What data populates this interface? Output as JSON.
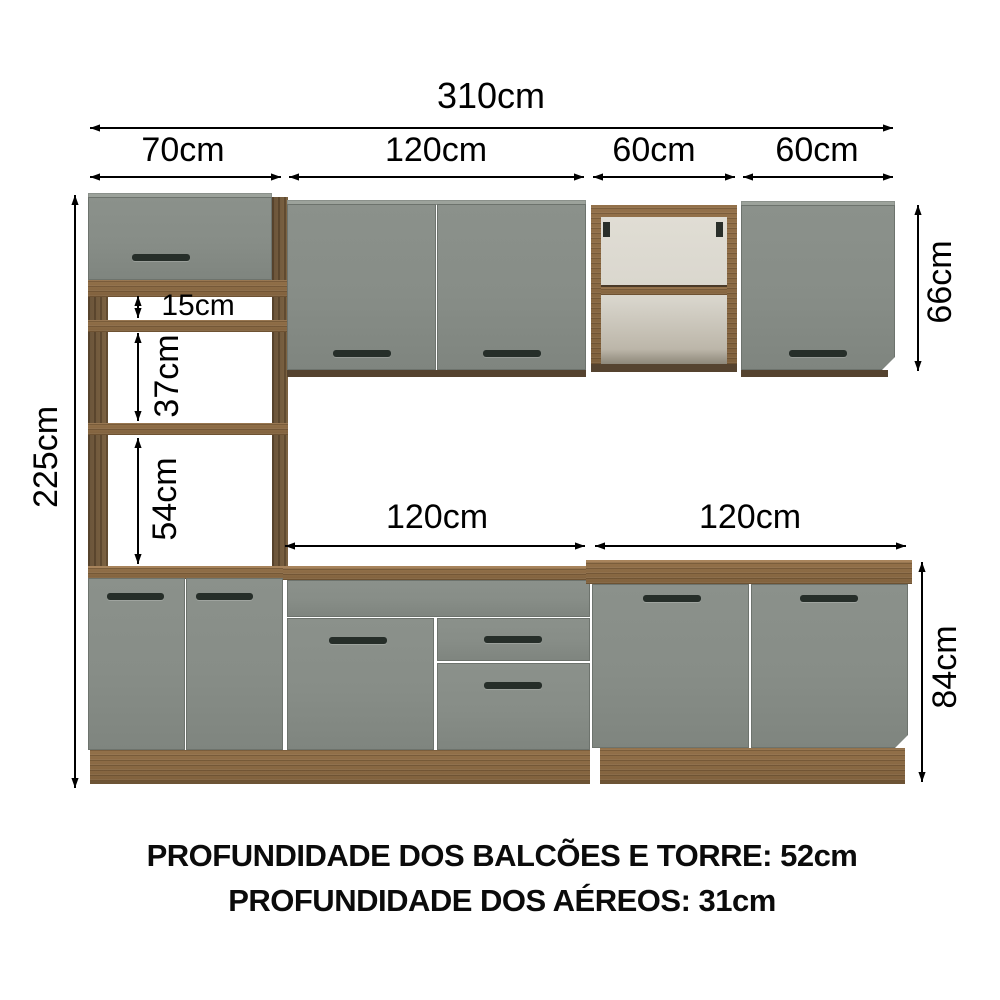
{
  "title": "kitchen-cabinet-dimension-diagram",
  "dimensions": {
    "total_width": "310cm",
    "tower_width": "70cm",
    "upper_center_width": "120cm",
    "upper_open_width": "60cm",
    "upper_right_width": "60cm",
    "total_height": "225cm",
    "niche_top_height": "15cm",
    "niche_middle_height": "37cm",
    "niche_bottom_height": "54cm",
    "upper_cabinet_height": "66cm",
    "base_center_width": "120cm",
    "base_right_width": "120cm",
    "base_cabinet_height": "84cm"
  },
  "footer": {
    "line1": "PROFUNDIDADE DOS BALCÕES E TORRE: 52cm",
    "line2": "PROFUNDIDADE DOS AÉREOS: 31cm"
  },
  "palette": {
    "background": "#ffffff",
    "door_gray": "#878d87",
    "wood_brown": "#8a6a44",
    "wood_dark": "#55432f",
    "handle_dark": "#262e29",
    "interior_cream": "#d9d6cd",
    "dimension_black": "#000000"
  }
}
